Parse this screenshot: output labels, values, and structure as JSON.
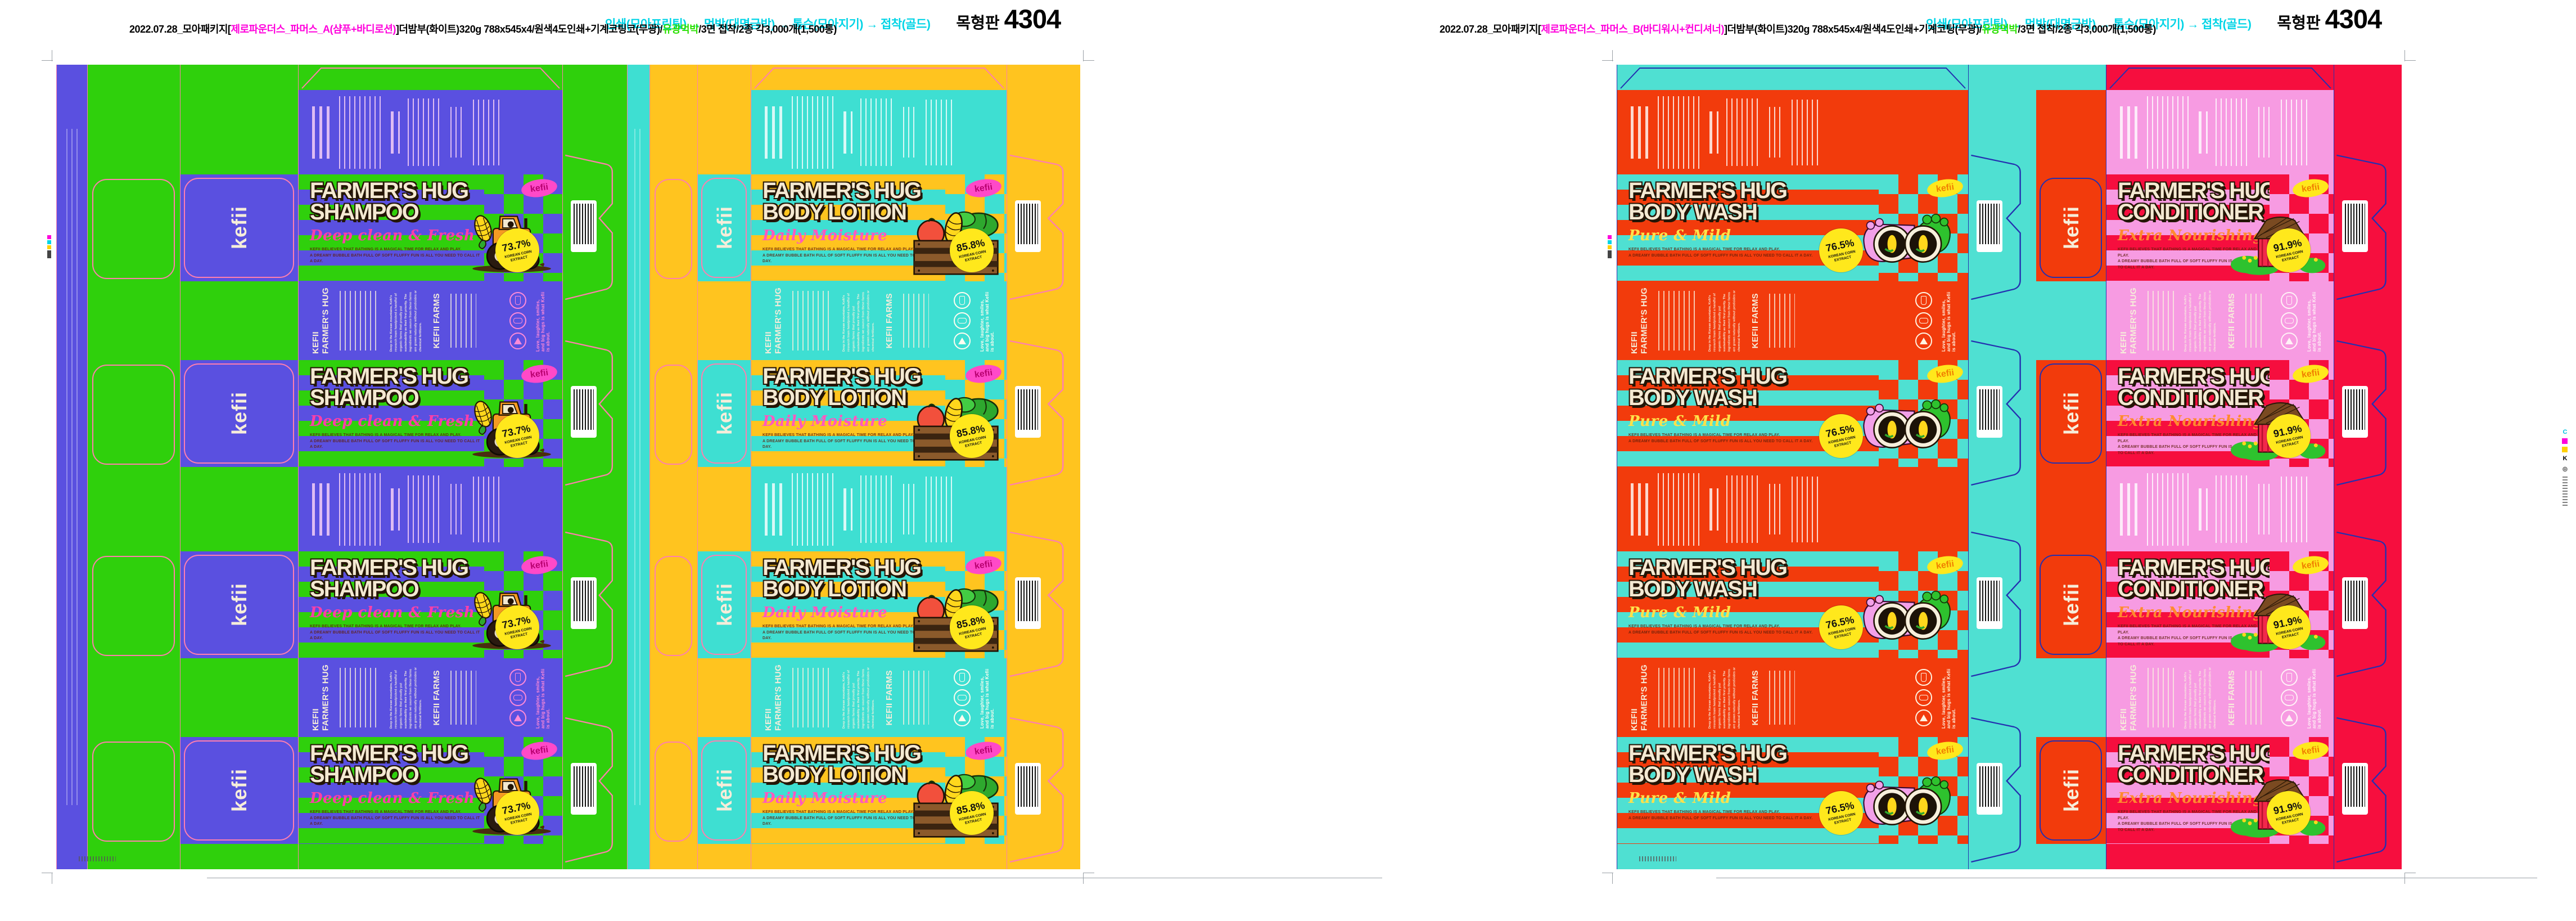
{
  "headers": {
    "left": {
      "process": "인쇄(모아프린팅) → 먹박(대명금박) → 톰슨(모아지기) → 접착(골드)",
      "plate_label": "목형판",
      "plate_number": "4304",
      "spec_prefix": "2022.07.28_모아패키지[",
      "spec_product": "제로파운더스_파머스_A(샴푸+바디로션)",
      "spec_mid": "]더밤부(화이트)320g 788x545x4/원색4도인쇄+기계코팅코(무광)/",
      "spec_foil": "유광먹박",
      "spec_suffix": "/3면 접착/2종 각3,000개(1,500통)"
    },
    "right": {
      "process": "인쇄(모아프린팅) → 먹박(대명금박) → 톰슨(모아지기) → 접착(골드)",
      "plate_label": "목형판",
      "plate_number": "4304",
      "spec_prefix": "2022.07.28_모아패키지[",
      "spec_product": "제로파운더스_파머스_B(바디워시+컨디셔너)",
      "spec_mid": "]더밤부(화이트)320g 788x545x4/원색4도인쇄+기계코팅(무광)/",
      "spec_foil": "유광먹박",
      "spec_suffix": "/3면 접착/2종 각3,000개(1,500통)"
    }
  },
  "brand": "kefii",
  "front_tagline_1": "KEFII BELIEVES THAT BATHING IS A MAGICAL TIME FOR RELAX AND PLAY.",
  "front_tagline_2": "A DREAMY BUBBLE BATH FULL OF SOFT FLUFFY FUN IS ALL YOU NEED TO CALL IT A DAY.",
  "badge_label": "KOREAN CORN EXTRACT",
  "products": [
    {
      "name": "shampoo",
      "title_line1": "FARMER'S HUG",
      "title_line2": "SHAMPOO",
      "subtitle": "Deep clean & Fresh",
      "badge_percent": "73.7%",
      "illustration": "tractor-with-corn",
      "colors": {
        "bg": "#2FD00C",
        "panel": "#5A50E0",
        "subtitle": "#FF3FA8",
        "oval_bg": "#FF49C8",
        "oval_text": "#B8006F",
        "accent_text": "#FF8AD8"
      }
    },
    {
      "name": "body-lotion",
      "title_line1": "FARMER'S HUG",
      "title_line2": "BODY LOTION",
      "subtitle": "Daily Moisture",
      "badge_percent": "85.8%",
      "illustration": "vegetable-crate",
      "colors": {
        "bg": "#FFC41F",
        "panel": "#3EDFD2",
        "subtitle": "#FF58C0",
        "oval_bg": "#FF49C8",
        "oval_text": "#B8006F",
        "accent_text": "#FFFDF0"
      }
    },
    {
      "name": "body-wash",
      "title_line1": "FARMER'S HUG",
      "title_line2": "BODY WASH",
      "subtitle": "Pure & Mild",
      "badge_percent": "76.5%",
      "illustration": "binoculars-with-corn",
      "colors": {
        "bg": "#4FE0D2",
        "panel": "#F23B0C",
        "subtitle": "#FFE14A",
        "oval_bg": "#FFE81C",
        "oval_text": "#F07F00",
        "accent_text": "#FFF4E2"
      }
    },
    {
      "name": "conditioner",
      "title_line1": "FARMER'S HUG",
      "title_line2": "CONDITIONER",
      "subtitle": "Extra Nourishing",
      "badge_percent": "91.9%",
      "illustration": "red-barn",
      "colors": {
        "bg": "#F60E3E",
        "panel": "#F79BE2",
        "subtitle": "#FF8A2E",
        "oval_bg": "#FFE81C",
        "oval_text": "#F07F00",
        "accent_text": "#FFF2F6"
      }
    }
  ],
  "back_panel": {
    "brand_line1": "KEFII",
    "brand_line2": "FARMER'S HUG",
    "farms_title": "KEFII FARMS",
    "story": "Deep in the Korean mountains, Kefii's research team handpicked a handful of organic farms that proudly put sustainability as their first priority. The ingredients we source from these farms are grown naturally without pesticides or chemical fertilizers.",
    "slogan": "Love, laughter, smiles, and big hugs is what Kefii is about."
  },
  "dieline": {
    "left": "#FF7FAE",
    "right": "#2430B0"
  },
  "marks": {
    "c": "C",
    "k": "K",
    "crosshair": "⊕"
  }
}
